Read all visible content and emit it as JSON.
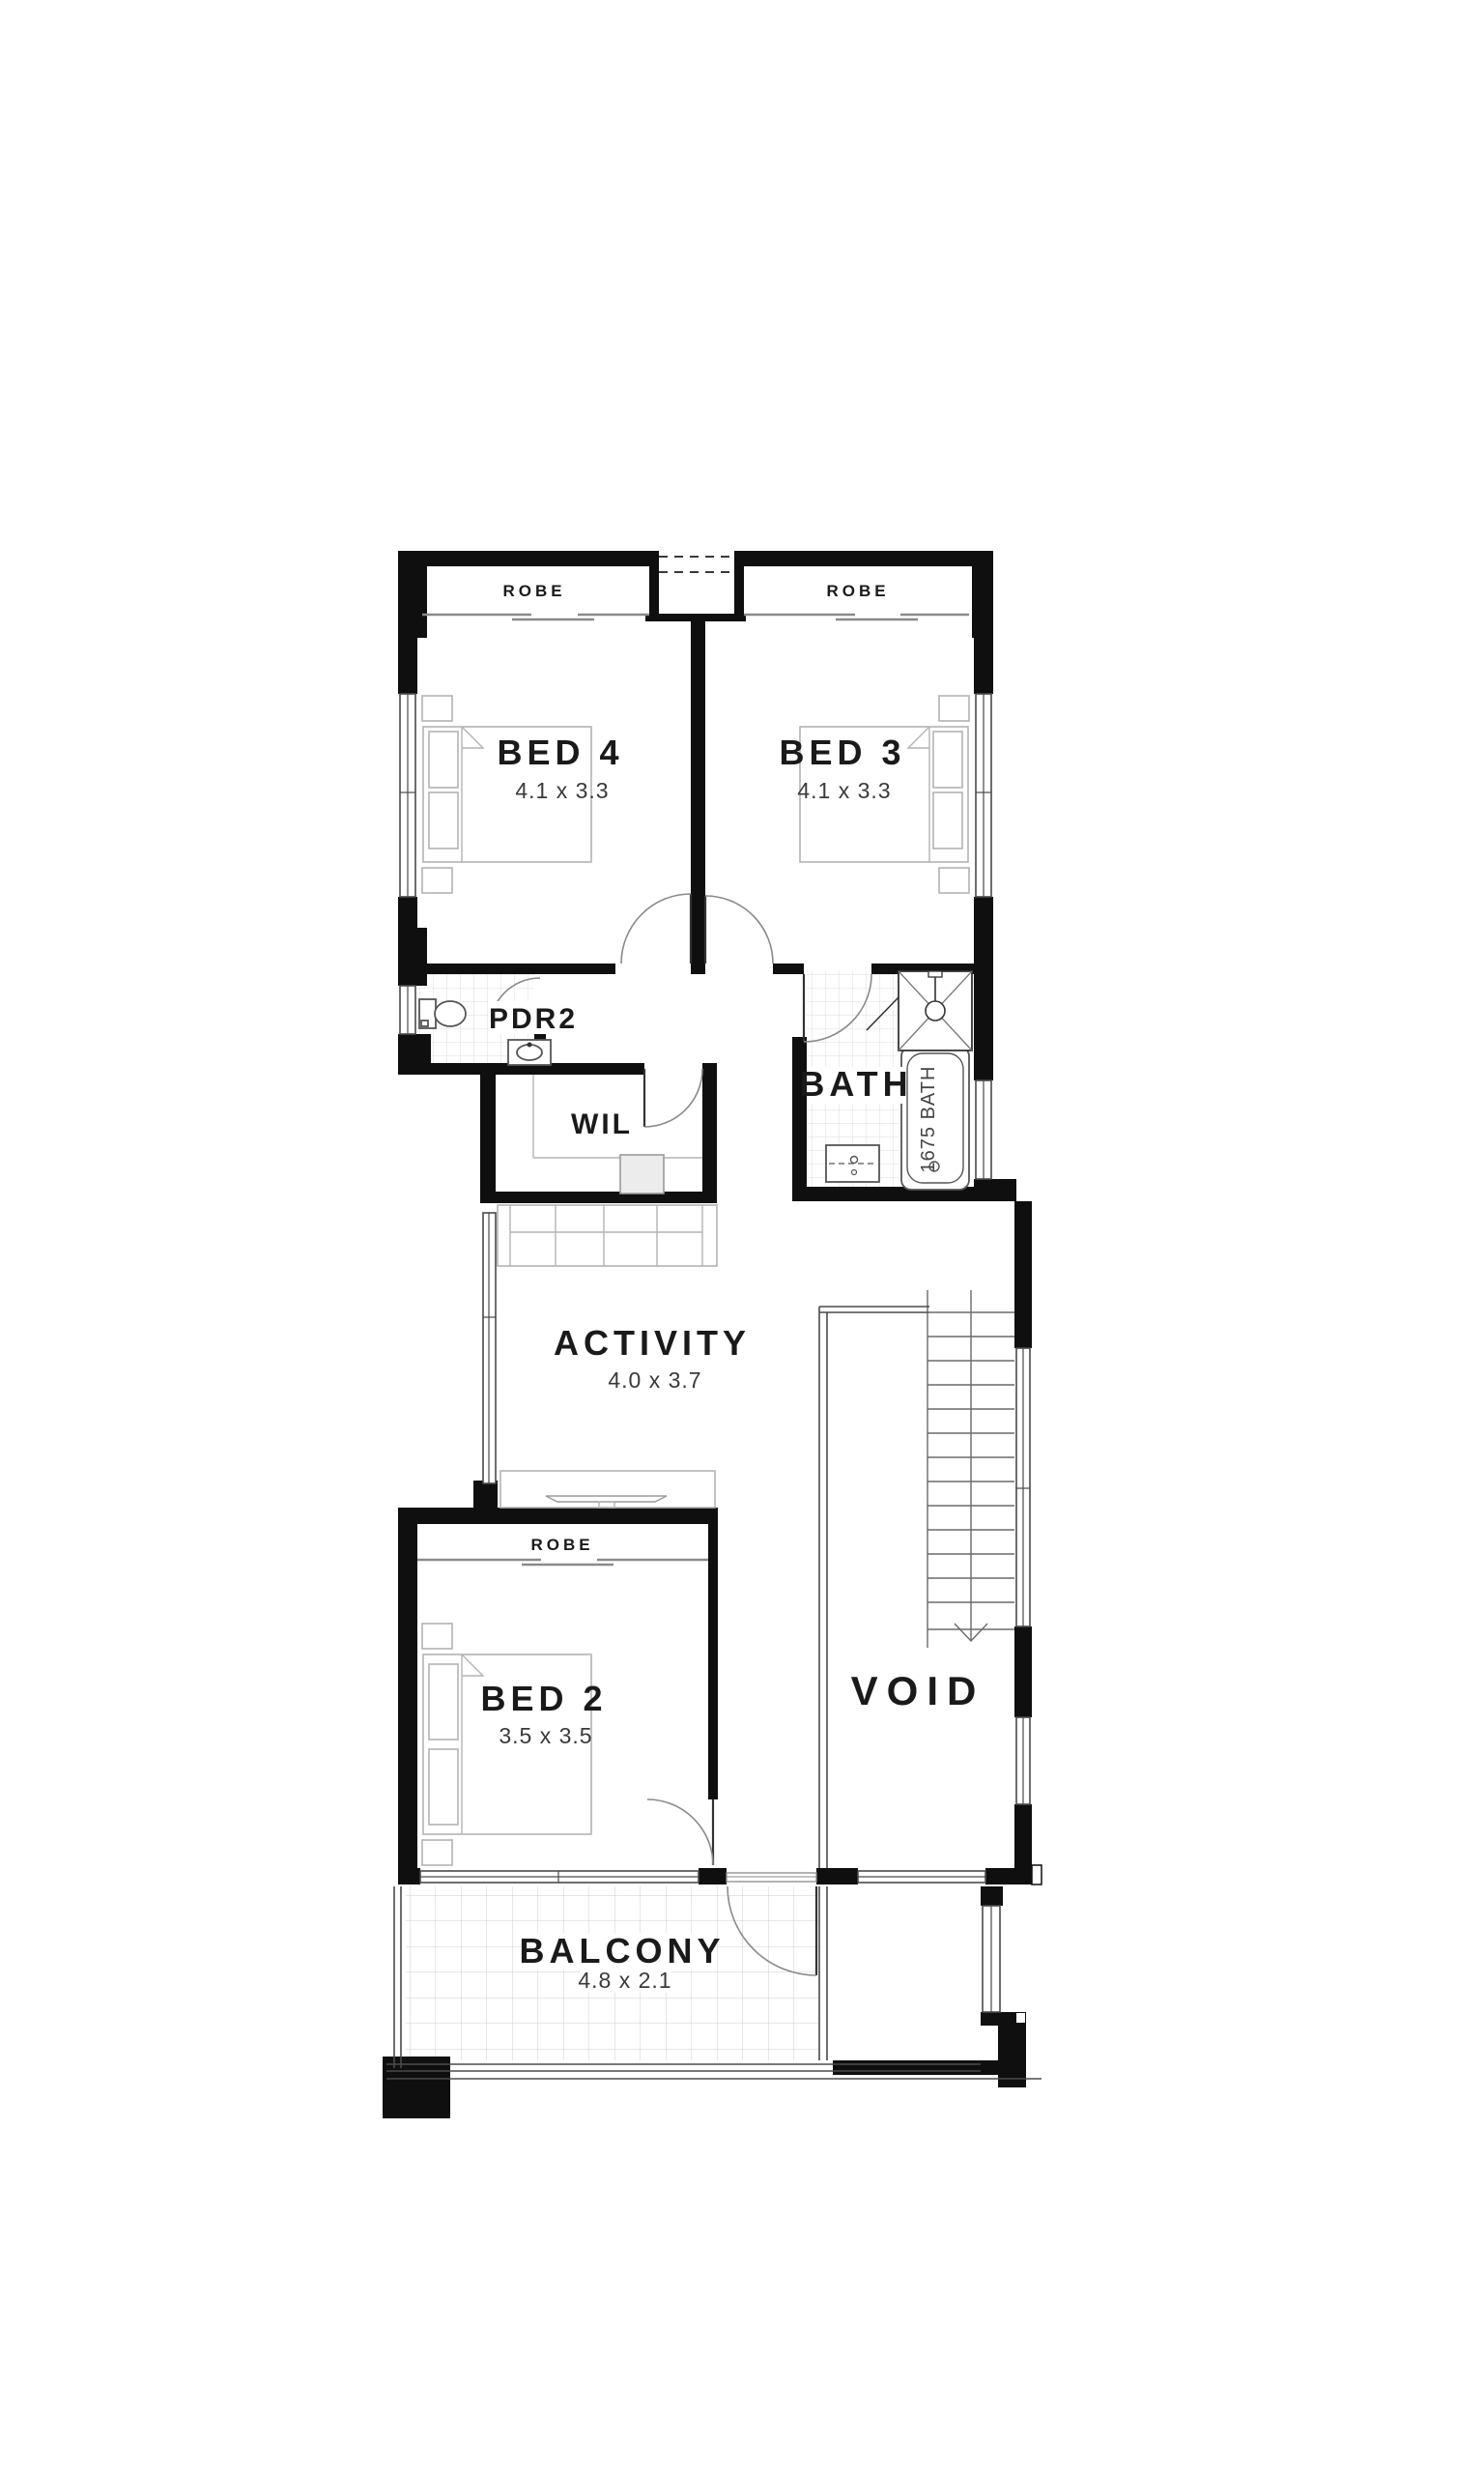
{
  "colors": {
    "wall": "#0f0f0f",
    "glazing": "#4a4a4a",
    "furniture": "#b3b3b3",
    "door_arc": "#8a8a8a",
    "tile": "#d9d9d9",
    "text": "#1a1a1a",
    "background": "#ffffff"
  },
  "plan": {
    "rooms": [
      {
        "id": "bed4",
        "label": "BED 4",
        "dims": "4.1 x 3.3"
      },
      {
        "id": "bed3",
        "label": "BED 3",
        "dims": "4.1 x 3.3"
      },
      {
        "id": "pdr2",
        "label": "PDR2",
        "dims": ""
      },
      {
        "id": "wil",
        "label": "WIL",
        "dims": ""
      },
      {
        "id": "bath",
        "label": "BATH",
        "dims": ""
      },
      {
        "id": "activity",
        "label": "ACTIVITY",
        "dims": "4.0 x 3.7"
      },
      {
        "id": "bed2",
        "label": "BED 2",
        "dims": "3.5 x 3.5"
      },
      {
        "id": "void",
        "label": "VOID",
        "dims": ""
      },
      {
        "id": "balcony",
        "label": "BALCONY",
        "dims": "4.8 x 2.1"
      }
    ],
    "robes": {
      "bed4": "ROBE",
      "bed3": "ROBE",
      "bed2": "ROBE"
    },
    "fixtures": {
      "bath_tub": "1675 BATH"
    }
  }
}
